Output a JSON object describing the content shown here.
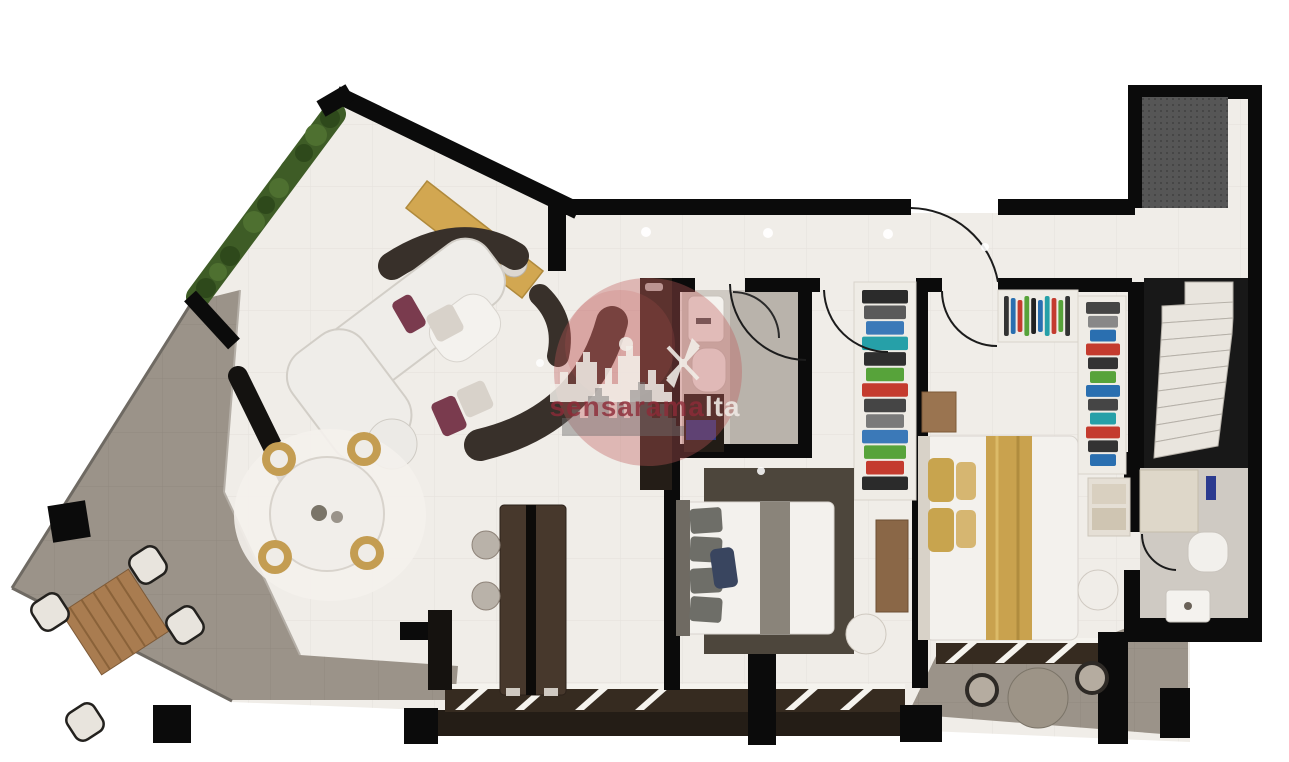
{
  "scene": {
    "type": "apartment-floor-plan-3d-render",
    "view": "top-down"
  },
  "watermark": {
    "brand": "sensaramalta",
    "brand_dark_part": "sensarama",
    "brand_light_part": "lta",
    "logo_elements": [
      "red-circle",
      "city-skyline-silhouette",
      "windmill"
    ]
  },
  "colors": {
    "wall": "#0b0b0b",
    "floor_marble": "#f0ede8",
    "floor_terrace": "#9b9389",
    "floor_bath": "#cfcac3",
    "floor_shower": "#b9b3ab",
    "tile_line": "#dcd8d2",
    "terrace_line": "#89817a",
    "hedge": "#3e5c26",
    "hedge_dark": "#2e491b",
    "hedge_light": "#4e7030",
    "console_yellow": "#d2a751",
    "island_brown": "#47382c",
    "cabinet_dark": "#241d17",
    "rug_zebra": "#38302a",
    "rug_bed1": "#4d463c",
    "bed_white": "#f3f1ed",
    "bed_stroke": "#d8d4ce",
    "gold_pillow": "#c8a44e",
    "gold_blanket": "#c9a24e",
    "chair_gold": "#c49d52",
    "pillow_maroon": "#7a3b4e",
    "pillow_navy": "#39455f",
    "wood": "#a97c50",
    "wood_dark": "#8a6747",
    "mat_blue": "#2b3a8f",
    "sill_brown": "#362b20",
    "fascia_brown": "#241d16",
    "step_white": "#e9e5de",
    "stair_void": "#181818",
    "shaft_gray": "#565656",
    "wm_red": "#c05a5a",
    "wm_dark_red": "#8e2b38",
    "wm_light_text": "#efe9e4",
    "glass_line": "#2a2a2a"
  },
  "closets": {
    "wardrobe_hall": {
      "colors": [
        "#2b2b2b",
        "#5a5a5a",
        "#3b79b8",
        "#26a0a8",
        "#2f2f2f",
        "#57a33a",
        "#c43b2e",
        "#454545",
        "#7a7a7a",
        "#3b79b8",
        "#57a33a",
        "#c43b2e",
        "#2b2b2b"
      ]
    },
    "closet_top": {
      "colors": [
        "#333333",
        "#2a6fb0",
        "#c43b2e",
        "#57a33a",
        "#222222",
        "#2a6fb0",
        "#26a0a8",
        "#c43b2e",
        "#57a33a",
        "#333333"
      ]
    },
    "closet_right": {
      "colors": [
        "#454545",
        "#888888",
        "#2a6fb0",
        "#c43b2e",
        "#333333",
        "#57a33a",
        "#2a6fb0",
        "#454545",
        "#26a0a8",
        "#c43b2e",
        "#333333",
        "#2a6fb0"
      ]
    }
  },
  "rooms": [
    {
      "name": "terrace",
      "furniture": [
        "outdoor-table",
        "outdoor-chairs",
        "hedge"
      ]
    },
    {
      "name": "living-dining",
      "furniture": [
        "sofa",
        "zebra-rug",
        "console",
        "round-table",
        "gold-chairs",
        "media-bench"
      ]
    },
    {
      "name": "kitchen",
      "furniture": [
        "island",
        "stools",
        "tall-cabinet"
      ]
    },
    {
      "name": "hallway",
      "furniture": [
        "ceiling-lights"
      ]
    },
    {
      "name": "bathroom-1",
      "furniture": [
        "sink",
        "toilet",
        "shower-glass",
        "vanity"
      ]
    },
    {
      "name": "bedroom-1",
      "furniture": [
        "double-bed",
        "rug",
        "dresser",
        "chair",
        "wardrobe"
      ]
    },
    {
      "name": "bedroom-2",
      "furniture": [
        "double-bed",
        "nightstand",
        "closets",
        "stool"
      ]
    },
    {
      "name": "bathroom-2",
      "furniture": [
        "toilet",
        "sink",
        "shelf"
      ]
    },
    {
      "name": "stairwell",
      "furniture": [
        "stairs",
        "shaft"
      ]
    },
    {
      "name": "rear-terrace",
      "furniture": [
        "round-table",
        "chairs"
      ]
    }
  ]
}
